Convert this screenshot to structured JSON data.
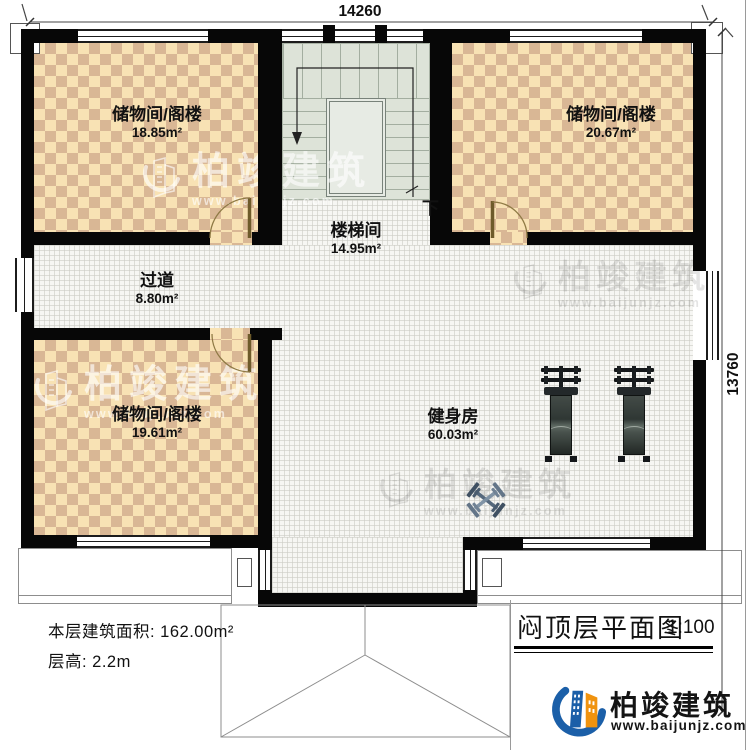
{
  "page": {
    "dimension_top": "14260",
    "dimension_right": "13760"
  },
  "rooms": [
    {
      "name": "储物间/阁楼",
      "area": "18.85m²"
    },
    {
      "name": "储物间/阁楼",
      "area": "20.67m²"
    },
    {
      "name": "楼梯间",
      "area": "14.95m²"
    },
    {
      "name": "过道",
      "area": "8.80m²"
    },
    {
      "name": "储物间/阁楼",
      "area": "19.61m²"
    },
    {
      "name": "健身房",
      "area": "60.03m²"
    }
  ],
  "stairs": {
    "down_label": "下"
  },
  "info": {
    "floor_area": "本层建筑面积: 162.00m²",
    "floor_height": "层高: 2.2m"
  },
  "title_block": {
    "title": "闷顶层平面图",
    "scale": "1:100"
  },
  "brand": {
    "name": "柏竣建筑",
    "website": "www.baijunjz.com"
  },
  "watermark": {
    "name": "柏竣建筑",
    "website": "www.baijunjz.com"
  },
  "colors": {
    "wall": "#070707",
    "checker_light": "#f8e2b4",
    "checker_dark": "#d9b795",
    "stair_fill": "#dde3d8",
    "floor_grid": "#f6f6f3",
    "logo_blue": "#1b5fa8",
    "logo_orange": "#f0930f",
    "equipment_gray": "#3a423e",
    "dumbbell_steel": "#55687c"
  }
}
